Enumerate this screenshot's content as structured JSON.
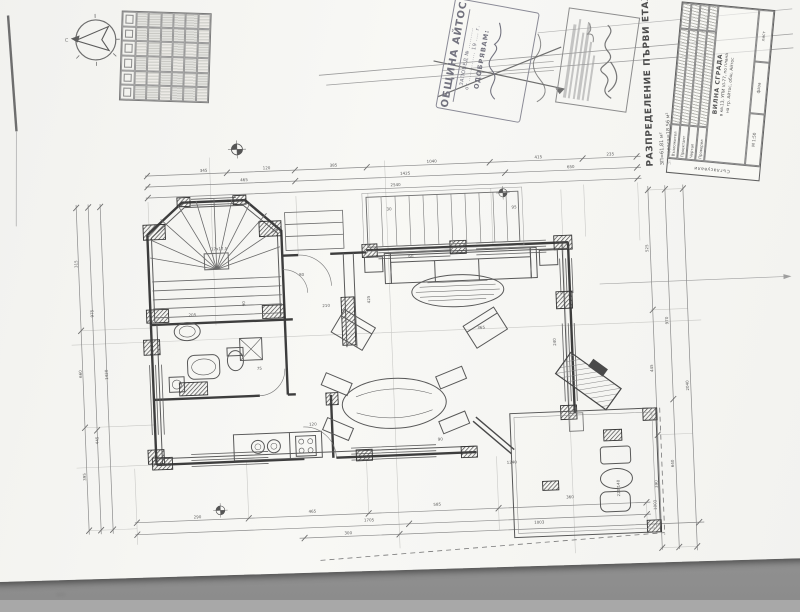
{
  "document": {
    "drawing_title_vertical": "РАЗПРЕДЕЛЕНИЕ  ПЪРВИ  ЕТАЖ",
    "area_note_1": "ЗП=61,81 м²",
    "area_note_2": "ЗП тераса=18,56 м²"
  },
  "approval_stamp": {
    "org": "ОБЩИНА АЙТОС",
    "line1": "ЗАПОВЕД № ..........",
    "line2": "от .............. 19 .... г.",
    "approve": "ОДОБРЯВАМ:"
  },
  "title_block": {
    "side_label": "Съгласували",
    "roles": [
      "Възложител",
      "Проектант",
      "Чертал",
      "Проверил"
    ],
    "project_name": "ВИЛНА СГРАДА",
    "project_loc1": "в кв.13, УПИ VI-77, по плана",
    "project_loc2": "на гр. Айтос, общ. Айтос",
    "scale_label": "М 1:50",
    "phase_label": "фаза",
    "sheet_label": "лист"
  },
  "compass": {
    "north_label": "С"
  },
  "plan": {
    "dim_labels": [
      {
        "x": 205,
        "y": 164,
        "t": "345"
      },
      {
        "x": 268,
        "y": 164,
        "t": "120"
      },
      {
        "x": 335,
        "y": 164,
        "t": "385"
      },
      {
        "x": 432,
        "y": 164,
        "t": "1040"
      },
      {
        "x": 540,
        "y": 164,
        "t": "415"
      },
      {
        "x": 612,
        "y": 164,
        "t": "235"
      },
      {
        "x": 245,
        "y": 175,
        "t": "465"
      },
      {
        "x": 405,
        "y": 175,
        "t": "1425"
      },
      {
        "x": 572,
        "y": 175,
        "t": "650"
      },
      {
        "x": 395,
        "y": 186,
        "t": "2540"
      },
      {
        "x": 79,
        "y": 255,
        "r": -90,
        "t": "315"
      },
      {
        "x": 79,
        "y": 365,
        "r": -90,
        "t": "660"
      },
      {
        "x": 79,
        "y": 468,
        "r": -90,
        "t": "395"
      },
      {
        "x": 93,
        "y": 305,
        "r": -90,
        "t": "975"
      },
      {
        "x": 93,
        "y": 432,
        "r": -90,
        "t": "445"
      },
      {
        "x": 105,
        "y": 368,
        "r": -90,
        "t": "1420"
      },
      {
        "x": 185,
        "y": 510,
        "t": "290"
      },
      {
        "x": 300,
        "y": 509,
        "t": "465"
      },
      {
        "x": 425,
        "y": 507,
        "t": "585"
      },
      {
        "x": 558,
        "y": 505,
        "t": "360"
      },
      {
        "x": 355,
        "y": 520,
        "t": "1705"
      },
      {
        "x": 335,
        "y": 532,
        "t": "300"
      },
      {
        "x": 525,
        "y": 529,
        "t": "1003"
      },
      {
        "x": 650,
        "y": 262,
        "r": -90,
        "t": "525"
      },
      {
        "x": 650,
        "y": 382,
        "r": -90,
        "t": "445"
      },
      {
        "x": 650,
        "y": 498,
        "r": -90,
        "t": "390"
      },
      {
        "x": 667,
        "y": 335,
        "r": -90,
        "t": "970"
      },
      {
        "x": 667,
        "y": 478,
        "r": -90,
        "t": "640"
      },
      {
        "x": 685,
        "y": 402,
        "r": -90,
        "t": "2040"
      },
      {
        "x": 213,
        "y": 243,
        "t": "17x17,5"
      },
      {
        "x": 300,
        "y": 272,
        "t": "80"
      },
      {
        "x": 322,
        "y": 304,
        "t": "210"
      },
      {
        "x": 254,
        "y": 364,
        "t": "75"
      },
      {
        "x": 476,
        "y": 332,
        "t": "365"
      },
      {
        "x": 304,
        "y": 422,
        "t": "120"
      },
      {
        "x": 432,
        "y": 442,
        "t": "90"
      },
      {
        "x": 370,
        "y": 302,
        "r": -90,
        "t": "425"
      },
      {
        "x": 554,
        "y": 352,
        "r": -90,
        "t": "240"
      },
      {
        "x": 612,
        "y": 505,
        "r": -90,
        "t": "220/140"
      },
      {
        "x": 648,
        "y": 520,
        "r": -90,
        "t": "1003"
      },
      {
        "x": 500,
        "y": 468,
        "t": "1240"
      },
      {
        "x": 245,
        "y": 300,
        "r": -90,
        "t": "90"
      },
      {
        "x": 410,
        "y": 258,
        "t": "60"
      },
      {
        "x": 188,
        "y": 308,
        "t": "205"
      },
      {
        "x": 515,
        "y": 213,
        "t": "95"
      },
      {
        "x": 390,
        "y": 210,
        "t": "30"
      }
    ]
  }
}
